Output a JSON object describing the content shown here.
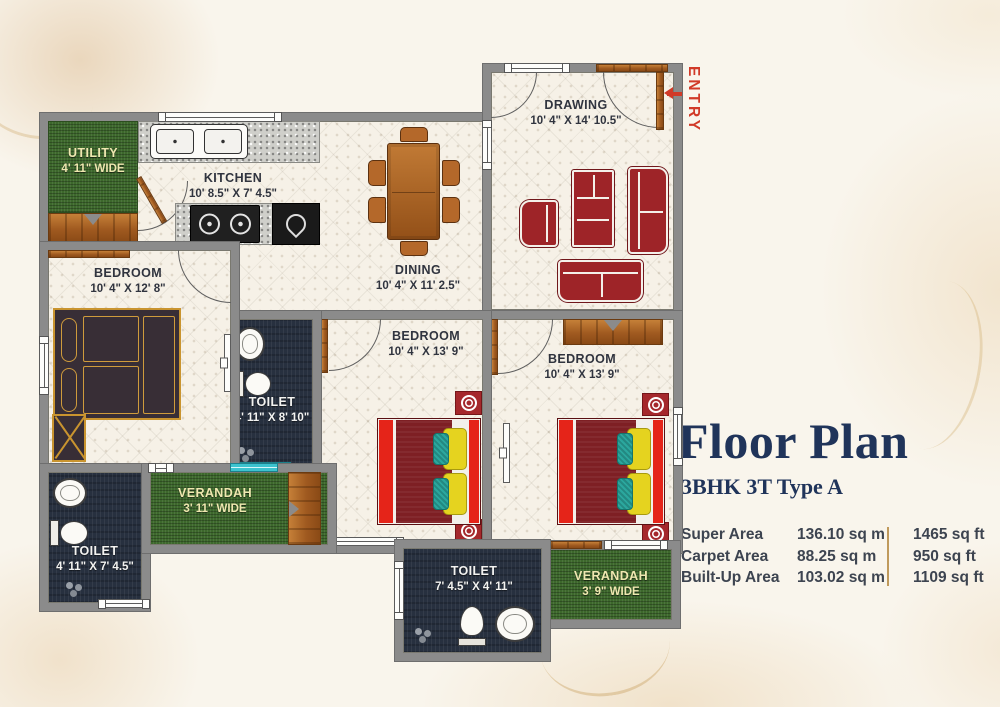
{
  "colors": {
    "background": "#f9f5ec",
    "wall_gray": "#8b8b8b",
    "floor_cream": "#f6f1e7",
    "toilet_navy": "#27303f",
    "garden_green": "#3d682c",
    "furniture_red": "#9e2428",
    "bed_maroon": "#7e1f24",
    "bed_bright_red": "#e52419",
    "pillow_yellow": "#e5d31f",
    "pillow_teal": "#2ba79e",
    "wood_brown": "#a05a20",
    "title_navy": "#20345a",
    "entry_red": "#d13a28",
    "divider_tan": "#c09a5c"
  },
  "plan": {
    "entry": "ENTRY",
    "rooms": {
      "drawing": {
        "name": "DRAWING",
        "dims": "10' 4\" X 14' 10.5\""
      },
      "kitchen": {
        "name": "KITCHEN",
        "dims": "10' 8.5\" X 7' 4.5\""
      },
      "utility": {
        "name": "UTILITY",
        "dims": "4' 11\" WIDE"
      },
      "dining": {
        "name": "DINING",
        "dims": "10' 4\" X 11' 2.5\""
      },
      "bedroom_left": {
        "name": "BEDROOM",
        "dims": "10' 4\" X 12' 8\""
      },
      "toilet_center": {
        "name": "TOILET",
        "dims": "4' 11\" X 8' 10\""
      },
      "bedroom_mid": {
        "name": "BEDROOM",
        "dims": "10' 4\" X 13' 9\""
      },
      "bedroom_right": {
        "name": "BEDROOM",
        "dims": "10' 4\" X 13' 9\""
      },
      "toilet_left": {
        "name": "TOILET",
        "dims": "4' 11\" X 7' 4.5\""
      },
      "verandah_left": {
        "name": "VERANDAH",
        "dims": "3' 11\" WIDE"
      },
      "toilet_bottom": {
        "name": "TOILET",
        "dims": "7' 4.5\" X 4' 11\""
      },
      "verandah_right": {
        "name": "VERANDAH",
        "dims": "3' 9\" WIDE"
      }
    }
  },
  "title_block": {
    "title": "Floor Plan",
    "subtitle": "3BHK 3T Type A",
    "areas": [
      {
        "label": "Super Area",
        "sqm": "136.10 sq m",
        "sqft": "1465 sq ft"
      },
      {
        "label": "Carpet Area",
        "sqm": "88.25 sq m",
        "sqft": "950 sq ft"
      },
      {
        "label": "Built-Up Area",
        "sqm": "103.02 sq m",
        "sqft": "1109 sq ft"
      }
    ]
  }
}
